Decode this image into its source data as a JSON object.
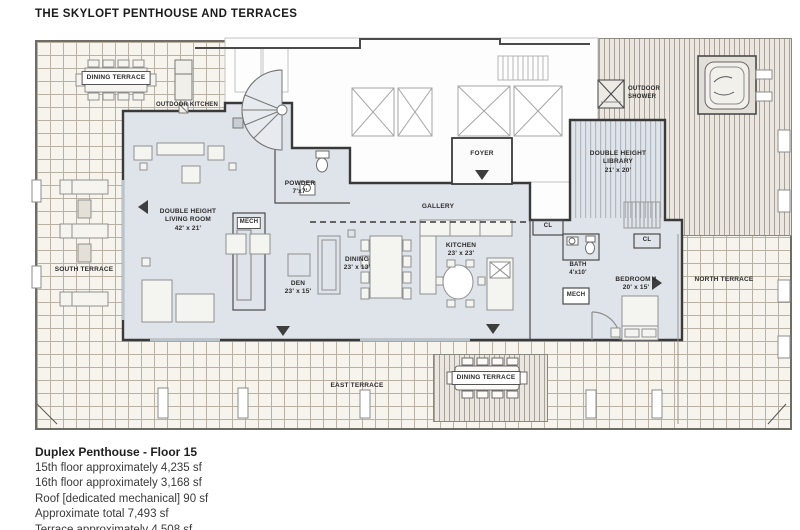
{
  "title": "THE SKYLOFT PENTHOUSE AND TERRACES",
  "plan": {
    "terraces": {
      "dining_top": "DINING TERRACE",
      "outdoor_kitchen": "OUTDOOR KITCHEN",
      "south": "SOUTH TERRACE",
      "north": "NORTH TERRACE",
      "east": "EAST TERRACE",
      "dining_bottom": "DINING TERRACE",
      "outdoor_shower_l1": "OUTDOOR",
      "outdoor_shower_l2": "SHOWER"
    },
    "rooms": {
      "living": {
        "l1": "DOUBLE HEIGHT",
        "l2": "LIVING ROOM",
        "dims": "42' x 21'"
      },
      "library": {
        "l1": "DOUBLE HEIGHT",
        "l2": "LIBRARY",
        "dims": "21' x 20'"
      },
      "powder": {
        "name": "POWDER",
        "dims": "7'x7'"
      },
      "foyer": {
        "name": "FOYER"
      },
      "gallery": {
        "name": "GALLERY"
      },
      "den": {
        "name": "DEN",
        "dims": "23' x 15'"
      },
      "dining": {
        "name": "DINING",
        "dims": "23' x 13'"
      },
      "kitchen": {
        "name": "KITCHEN",
        "dims": "23' x 23'"
      },
      "bedroom4": {
        "name": "BEDROOM 4",
        "dims": "20' x 15'"
      },
      "bath": {
        "name": "BATH",
        "dims": "4'x10'"
      },
      "mech_left": {
        "name": "MECH"
      },
      "mech_right": {
        "name": "MECH"
      },
      "closet_foyer": {
        "name": "CL"
      },
      "closet_bedroom": {
        "name": "CL"
      }
    }
  },
  "footer": {
    "heading": "Duplex Penthouse - Floor 15",
    "lines": [
      "15th floor approximately 4,235 sf",
      "16th floor approximately 3,168 sf",
      "Roof [dedicated mechanical] 90 sf",
      "Approximate total 7,493 sf",
      "Terrace approximately 4,508 sf"
    ]
  },
  "colors": {
    "unit_fill": "#dfe4ea",
    "wall": "#3a3a3a",
    "tile_line": "#b9b1a4"
  }
}
